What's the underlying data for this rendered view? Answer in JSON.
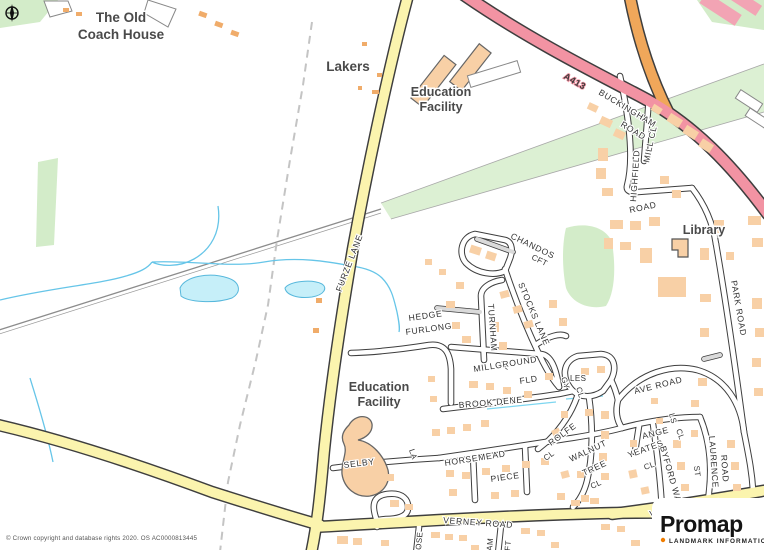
{
  "canvas": {
    "width": 764,
    "height": 550
  },
  "colors": {
    "background": "#ffffff",
    "road_a_class": "#F293A3",
    "road_b_class": "#F0A75A",
    "road_minor_yellow": "#FBF4AE",
    "road_local_white": "#FFFFFF",
    "road_private_gray": "#DADADA",
    "building": "#F8D0A6",
    "green_space": "#D3ECC9",
    "water_fill": "#C6EFF9",
    "water_line": "#5FBCDF",
    "boundary_dash": "#C4C4C4",
    "label_text": "#3C3C3C",
    "logo_accent": "#F07D00"
  },
  "labels": {
    "places": {
      "old_coach_house_1": "The Old",
      "old_coach_house_2": "Coach House",
      "lakers": "Lakers",
      "education_facility_north_1": "Education",
      "education_facility_north_2": "Facility",
      "education_facility_south_1": "Education",
      "education_facility_south_2": "Facility",
      "library": "Library"
    },
    "roads": {
      "a413": "A413",
      "buckingham_1": "BUCKINGHAM",
      "buckingham_2": "ROAD",
      "mill_cl": "MILL CL",
      "highfield_1": "HIGHFIELD",
      "highfield_2": "ROAD",
      "chandos": "CHANDOS",
      "chandos_cft": "CFT",
      "furze_lane": "FURZE LANE",
      "hedge_1": "HEDGE",
      "hedge_2": "FURLONG",
      "turnham": "TURNHAM",
      "turnham_cl": "CL",
      "stocks_lane": "STOCKS LANE",
      "millground_1": "MILLGROUND",
      "millground_2": "FLD",
      "brook_dene": "BROOK DENE",
      "gyles_1": "GY",
      "gyles_2": "LES",
      "gyles_3": "CL",
      "rolfe": "ROLFE",
      "rolfe_cl": "CL",
      "walnut_1": "WALNUT",
      "walnut_2": "TREE",
      "walnut_3": "CL",
      "ave_road": "AVE ROAD",
      "angels_1": "ANGE",
      "angels_2": "LS",
      "angels_3": "CL",
      "yeates": "YEATES",
      "yeates_cl": "CL",
      "byford_way": "BYFORD WAY",
      "st": "ST",
      "laurence": "LAURENCE",
      "laurence_road": "ROAD",
      "park_road": "PARK ROAD",
      "vicarage_road": "VICARAGE ROAD",
      "verney_road": "VERNEY ROAD",
      "selby": "SELBY",
      "selby_la": "LA",
      "horsemead_1": "HORSEMEAD",
      "horsemead_2": "PIECE",
      "partial_1": "OSE",
      "partial_2": "AM",
      "partial_3": "FT"
    }
  },
  "attribution": {
    "copyright": "© Crown copyright and database rights 2020. OS AC0000813445"
  },
  "logo": {
    "brand": "Promap",
    "subtitle": "LANDMARK INFORMATION"
  }
}
